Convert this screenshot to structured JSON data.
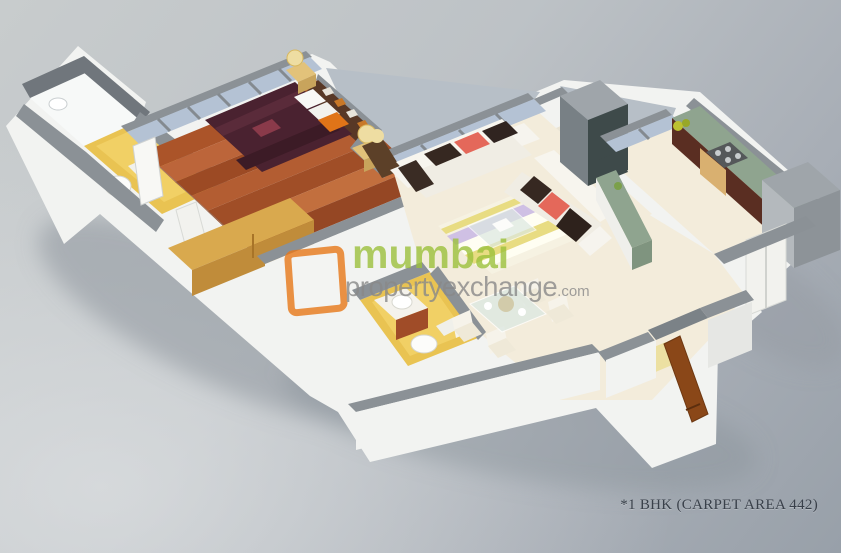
{
  "watermark": {
    "brand_primary": "mumbai",
    "brand_secondary": "propertyexchange",
    "brand_tld": ".com",
    "green": "#9cc13c",
    "gray": "#898989",
    "orange": "#e87818"
  },
  "caption": {
    "text": "*1 BHK (CARPET AREA 442)"
  },
  "colors": {
    "wall_top": "#8b9196",
    "wall_dark": "#70767c",
    "wall_face": "#f2f3f1",
    "wall_face_shaded": "#e6e7e4",
    "ledge": "#b7bfc7",
    "wood_floor": "#a8542b",
    "bathroom_floor": "#e9c352",
    "cream_floor": "#f3ecdb",
    "shower_floor": "#f7f9f8",
    "window_glass": "#b4c2d4",
    "counter_green": "#8fa48f",
    "cabinet_dark": "#5a2e22",
    "cabinet_light": "#d9b070",
    "duct_dark": "#3e4a4a",
    "bed_maroon": "#4a2230",
    "pillow_white": "#f8f8f6",
    "accent_orange": "#e07418",
    "sofa_cream": "#f7f5ee",
    "cushion_coral": "#e4685a",
    "cushion_brown": "#362821",
    "rug_lavender": "#cfc0e4",
    "rug_yellow": "#e8dc82",
    "door_brown": "#8a4718",
    "wardrobe_wood": "#d9a94e",
    "nightstand_wood": "#e2c27a",
    "lamp_shade": "#eedda2",
    "vanity_wood": "#a04c28",
    "fixture_white": "#fcfcfa",
    "glass_table": "#dce8e2",
    "gray_block": "#9fa5aa"
  }
}
